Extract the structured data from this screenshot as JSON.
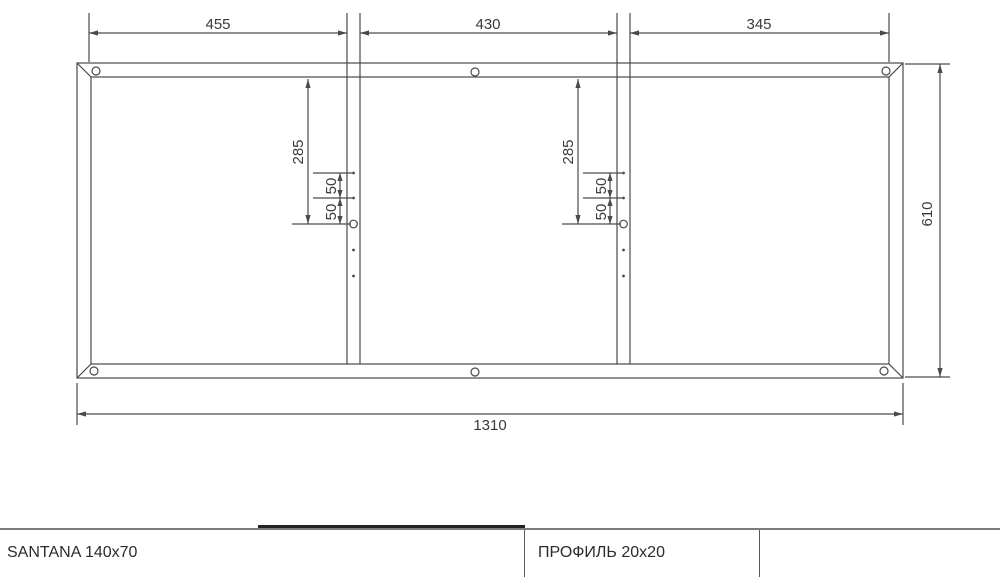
{
  "drawing": {
    "units": "mm",
    "dims": {
      "top_left": "455",
      "top_mid": "430",
      "top_right": "345",
      "total_width": "1310",
      "total_height": "610",
      "strut1_offset": "285",
      "strut1_gap1": "50",
      "strut1_gap2": "50",
      "strut2_offset": "285",
      "strut2_gap1": "50",
      "strut2_gap2": "50"
    },
    "dimensions_mm": {
      "top_segments": [
        455,
        430,
        345
      ],
      "overall_width": 1310,
      "overall_height": 610,
      "strut_big_hole_offset_from_top_rail": 285,
      "strut_hole_spacing": 50,
      "profile_size": "20x20"
    },
    "structure": {
      "frame": "rectangle with mitered corners",
      "vertical_struts": 2,
      "corner_holes": 4,
      "mid_rail_holes": 2,
      "strut_big_holes": 2,
      "strut_small_holes_per_strut": 4
    }
  },
  "title_block": {
    "cell1": "SANTANA 140x70",
    "cell2": "ПРОФИЛЬ 20x20",
    "cell3": ""
  },
  "colors": {
    "background": "#ffffff",
    "drawing_line": "#4a4a4a",
    "dimension_text": "#3a3a3a",
    "table_border": "#7b7b7b",
    "table_divider": "#5a5a5a",
    "dark_edge_segment": "#222222",
    "title_text": "#2b2b2b"
  }
}
